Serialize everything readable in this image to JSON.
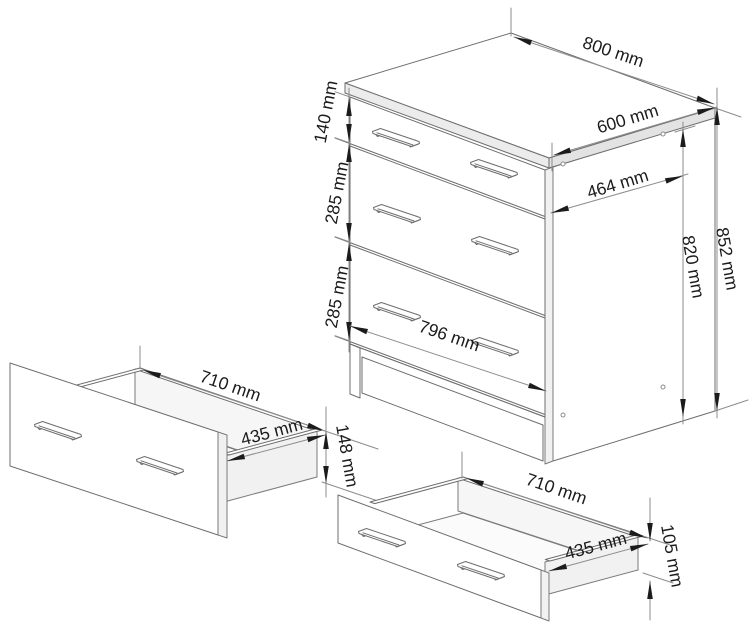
{
  "figure": {
    "kind": "furniture-dimension-diagram",
    "subject": "three-drawer chest with two pulled-out drawer boxes",
    "units": "mm"
  },
  "cabinet": {
    "top_width": "800 mm",
    "top_depth": "600 mm",
    "side_inner_depth": "464 mm",
    "total_height": "852 mm",
    "carcass_height": "820 mm",
    "top_drawer_front_height": "140 mm",
    "middle_drawer_front_height": "285 mm",
    "bottom_drawer_front_height": "285 mm",
    "front_width": "796 mm"
  },
  "drawer_large": {
    "width": "710 mm",
    "depth": "435 mm",
    "side_height": "148 mm"
  },
  "drawer_small": {
    "width": "710 mm",
    "depth": "435 mm",
    "side_height": "105 mm"
  },
  "style": {
    "background": "#ffffff",
    "line_color": "#6e6e6e",
    "dim_line_color": "#8d8d8d",
    "arrow_color": "#1b1b1b",
    "text_color": "#1b1b1b",
    "shade_color": "#ececec"
  }
}
